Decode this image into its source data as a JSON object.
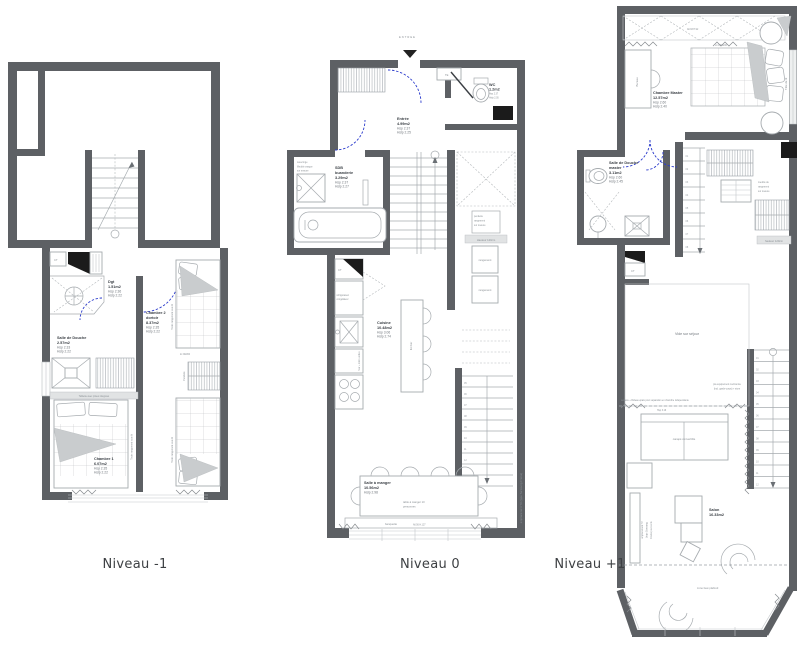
{
  "colors": {
    "wall": "#5d6064",
    "line": "#a6abaf",
    "thin": "#c3c7ca",
    "dash": "#b4b8bb",
    "door": "#2b3bcc",
    "black": "#1b1b1b",
    "text": "#3a3f45",
    "sub": "#71777d",
    "tiny": "#8a9095",
    "hl": "#e1e3e4",
    "fillgrey": "#c9ccce",
    "paper": "#ffffff"
  },
  "captions": {
    "minus1": "Niveau -1",
    "zero": "Niveau 0",
    "plus1": "Niveau +1"
  },
  "n1": {
    "ct": "CT",
    "dgt": [
      "Dgt",
      "1.51m2",
      "Hsp 2.36",
      "Hslp 2.22"
    ],
    "sdd": [
      "Salle de Douche",
      "2.57m2",
      "Hsp 2.33",
      "Hslp 2.22"
    ],
    "tablette": "Tablette avec prises intégrées",
    "ch1": [
      "Chambre 1",
      "6.07m2",
      "Hsp 2.35",
      "Hslp 2.22"
    ],
    "ch2": [
      "Chambre 2",
      "dortoir",
      "8.37m2",
      "Hsp 2.35",
      "Hslp 2.22"
    ],
    "tiroirs": "Tiroirs rangement sous lit",
    "penderie": "Penderie",
    "lits": "2x 90/200"
  },
  "n0": {
    "entree_fleche": "ENTREE",
    "te": "TE",
    "wc": [
      "WC",
      "1.2m2",
      "Hsp 2.37",
      "Hslp 2.05"
    ],
    "entree": [
      "Entrée",
      "4.99m2",
      "Hsp 2.37",
      "Hslp 2.25"
    ],
    "sdb": [
      "SDB",
      "buanderie",
      "3.29m2",
      "Hsp 2.37",
      "Hslp 2.27"
    ],
    "lave_linge": "Lave linge",
    "meuble_vasque": [
      "Meuble vasque",
      "sur mesure"
    ],
    "frigo": [
      "réfrigérateur",
      "congélateur"
    ],
    "four": "four + micro-ondes",
    "cuisine": [
      "Cuisine",
      "10.48m2",
      "Hsp 3.06",
      "Hslp 2.74"
    ],
    "ilot": "Ilot bar",
    "penderie_note": [
      "penderie",
      "rangement",
      "sur mesure"
    ],
    "hauteur": "Hauteur 120cm",
    "rangement": "rangement",
    "sam": [
      "Salle à manger",
      "10.56m2",
      "Hslp 2.98"
    ],
    "table": [
      "table à manger 10",
      "personnes"
    ],
    "banquette": "banquette",
    "allege": "All.56 H.127",
    "tv": "emplacement TV (type Samsung Frame)",
    "stairs": [
      "05",
      "06",
      "07",
      "08",
      "09",
      "10",
      "11",
      "12"
    ]
  },
  "np1": {
    "allege": "All.93 H.92",
    "master": [
      "Chambre Master",
      "12.57m2",
      "Hsp 2.60",
      "Hslp 2.40"
    ],
    "lit": "Lit 160x200",
    "bureau": "Bureau",
    "tete_de_lit": "Tête de lit",
    "sddm": [
      "Salle de Douche",
      "master",
      "3.11m2",
      "Hsp 2.60",
      "Hslp 2.45"
    ],
    "ct": "CT",
    "meuble_note": [
      "meuble de",
      "rangement",
      "sur mesure"
    ],
    "hauteur": "hauteur 120cm",
    "vide": "Vide sur séjour",
    "mezz_note": [
      "pré-équipement mezzanine",
      "(incl. garde-corps) + store"
    ],
    "verriere": "verrière + Rideau épais pour séparation en chambre indépendante",
    "hsp": "Hsp 3.16",
    "canape": "canapé convertible",
    "salon": [
      "Salon",
      "16.33m2"
    ],
    "tv": [
      "emplacement TV",
      "(type Samsung",
      "Frame) sur socle"
    ],
    "faux_plafond": "zone faux plafond",
    "stairs": [
      "01",
      "02",
      "03",
      "04",
      "05",
      "06",
      "07",
      "08",
      "09",
      "10",
      "11",
      "12"
    ],
    "stairs_up": [
      "01",
      "02",
      "03",
      "04",
      "05",
      "06",
      "07",
      "08"
    ]
  }
}
